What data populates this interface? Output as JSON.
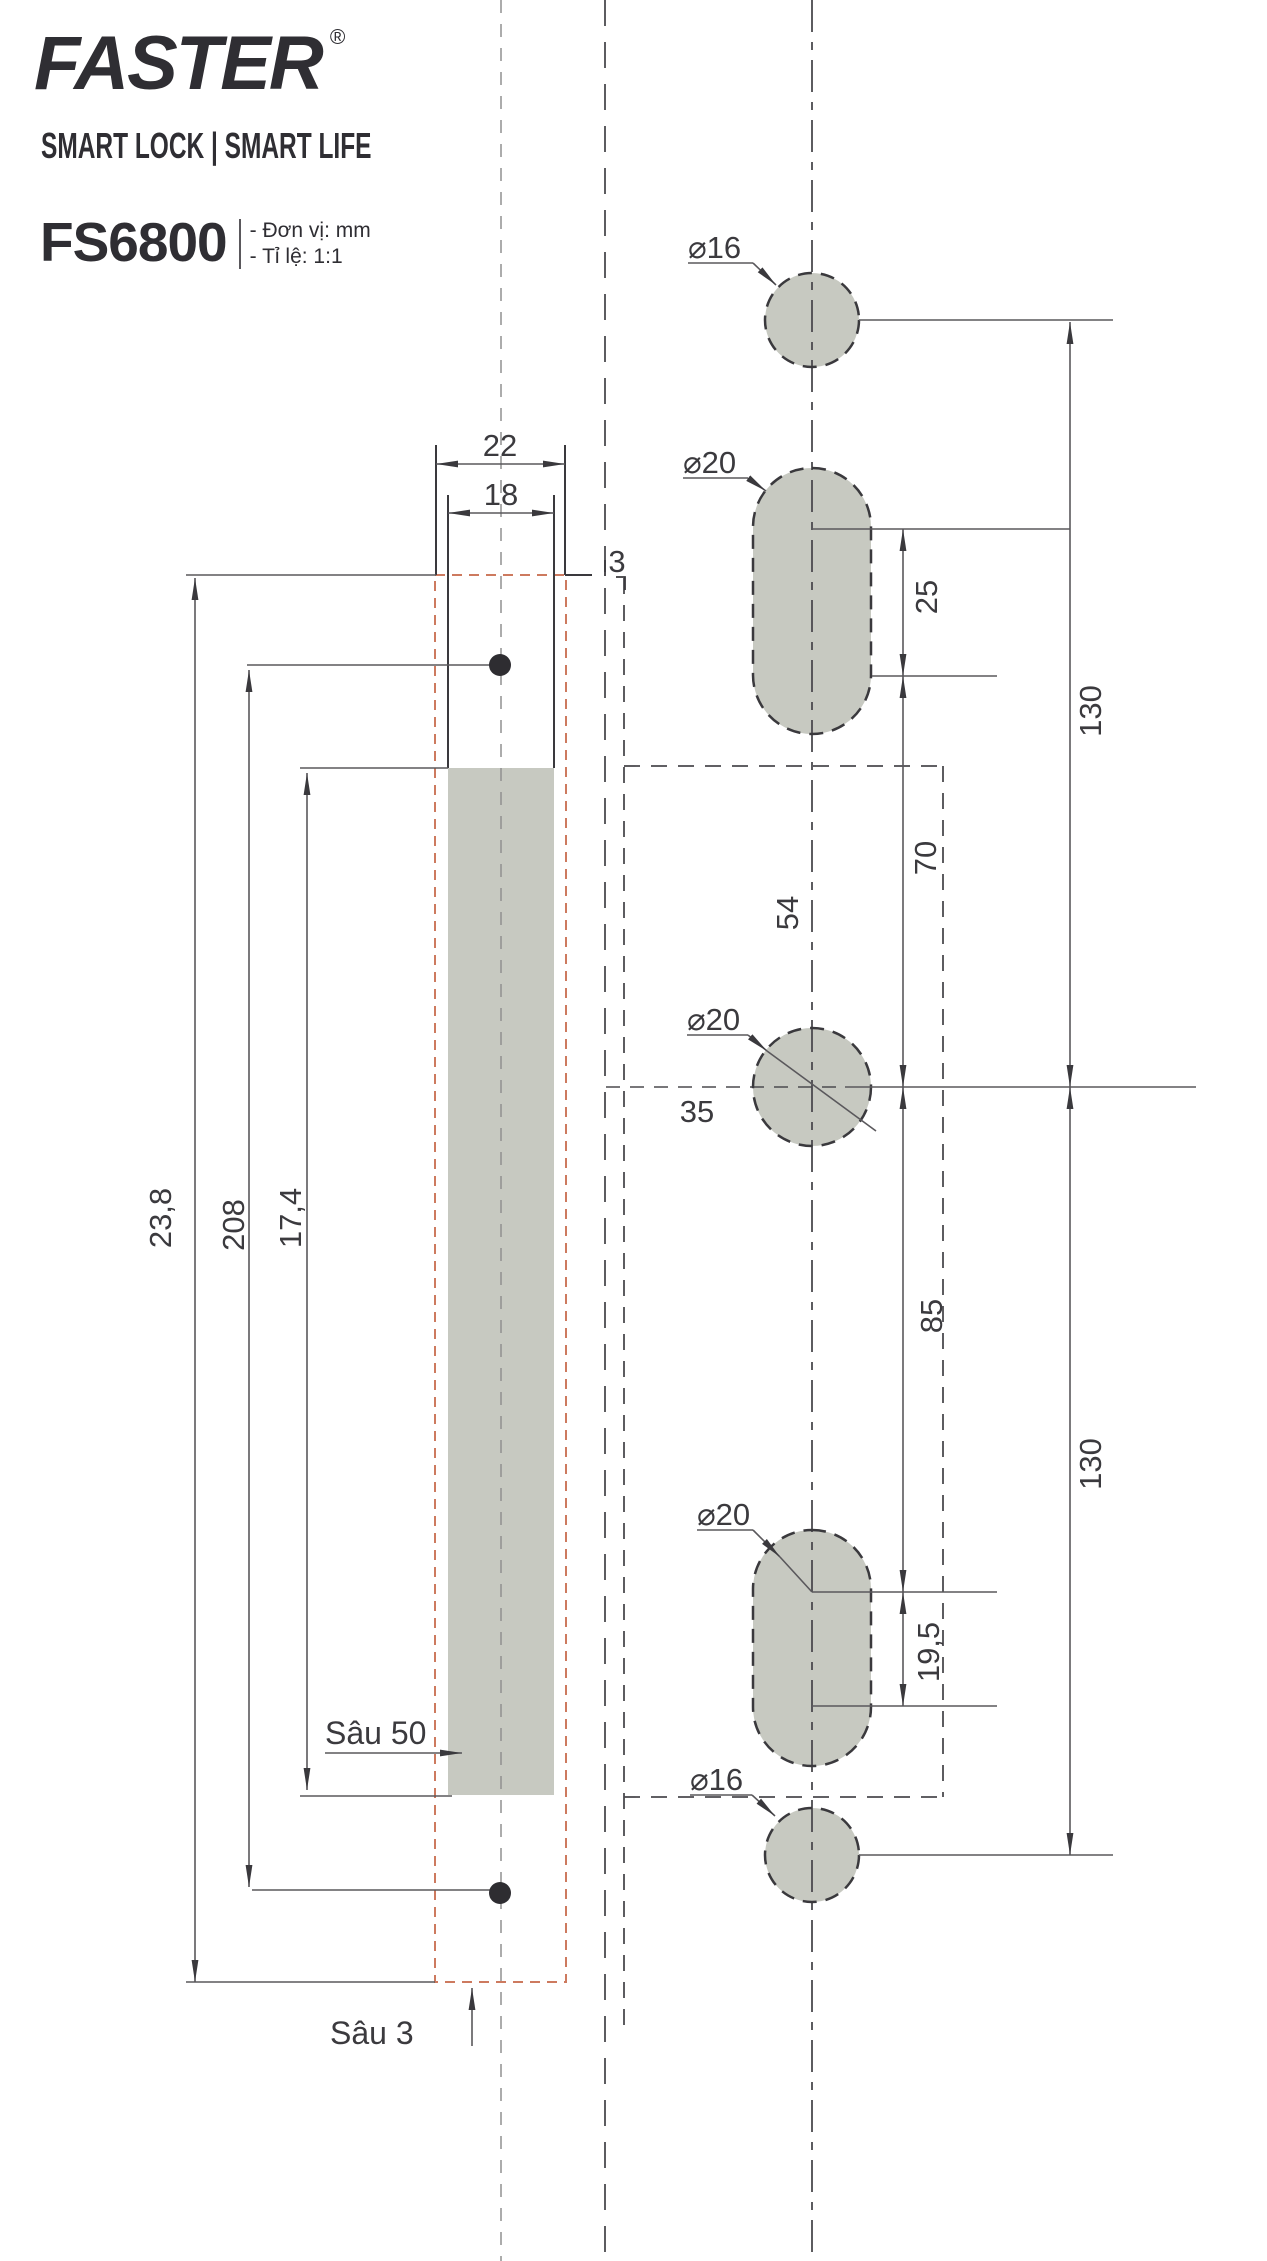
{
  "header": {
    "brand": "FASTER",
    "registered": "®",
    "tagline": "SMART LOCK | SMART LIFE",
    "model": "FS6800",
    "notes": [
      "- Đơn vị: mm",
      "- Tỉ lệ: 1:1"
    ]
  },
  "colors": {
    "object_line": "#3a393d",
    "dim_line": "#5a585c",
    "shape_fill": "#c7c9c1",
    "recess_dash_orange": "#cd7a5f",
    "centerline_light": "#909090"
  },
  "dimensions": {
    "plate_width": "22",
    "slot_width": "18",
    "recess_offset": "3",
    "plate_length": "23,8",
    "screw_spacing": "208",
    "slot_length": "17,4",
    "slot_depth_label": "Sâu 50",
    "recess_depth_label": "Sâu 3",
    "hole_top_dia": "⌀16",
    "hole_upper_dia": "⌀20",
    "hole_center_dia": "⌀20",
    "hole_lower_dia": "⌀20",
    "hole_bottom_dia": "⌀16",
    "upper_slot_span": "25",
    "upper_offset": "70",
    "backset_a": "54",
    "backset_b": "35",
    "lower_offset": "85",
    "lower_slot_span": "19,5",
    "top_to_center": "130",
    "center_to_bottom": "130"
  }
}
